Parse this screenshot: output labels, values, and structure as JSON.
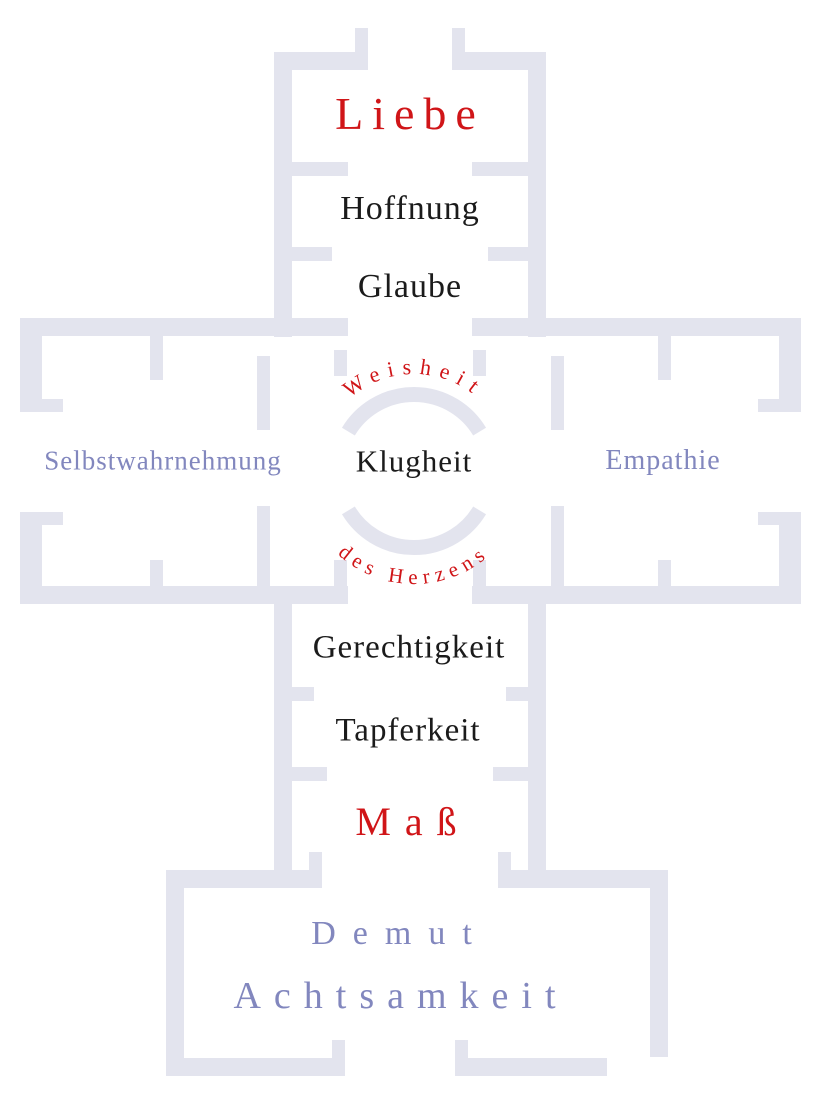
{
  "colors": {
    "background": "#ffffff",
    "wall": "#e3e4ee",
    "red": "#d01518",
    "ink": "#1b1b1b",
    "lavender": "#8287be"
  },
  "labels": {
    "liebe": "Liebe",
    "hoffnung": "Hoffnung",
    "glaube": "Glaube",
    "selbstwahrnehmung": "Selbstwahrnehmung",
    "klugheit": "Klugheit",
    "empathie": "Empathie",
    "weisheit": "Weisheit",
    "des_herzens": "des Herzens",
    "gerechtigkeit": "Gerechtigkeit",
    "tapferkeit": "Tapferkeit",
    "mass": "Maß",
    "demut": "Demut",
    "achtsamkeit": "Achtsamkeit"
  }
}
